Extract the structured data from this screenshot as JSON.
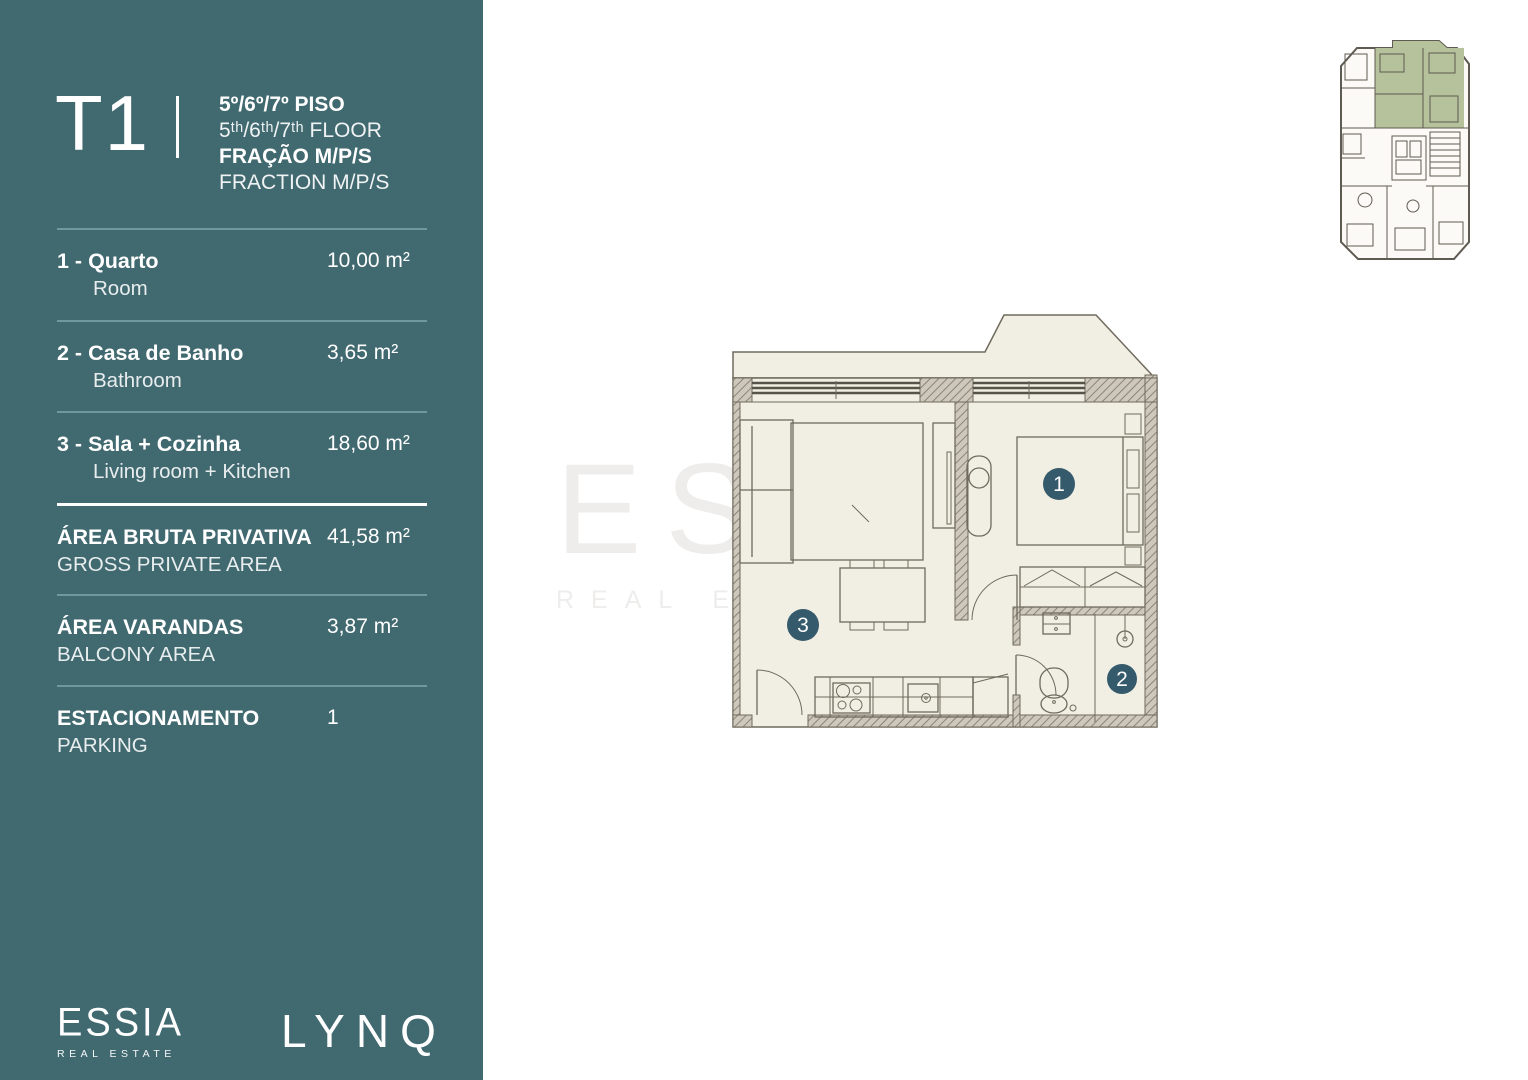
{
  "theme": {
    "sidebar-bg": "#416970",
    "divider": "#6d989c",
    "divider-strong": "#ffffff",
    "plan-floor": "#f1eee3",
    "plan-line": "#6f6a5d",
    "plan-wall-fill": "#cdc8bb",
    "plan-hatch": "#8a8478",
    "plan-glazing": "#57534b",
    "marker-bg": "#355a6b",
    "mini-highlight": "#b5c29c",
    "mini-line": "#5f5b52",
    "watermark": "rgba(150,145,135,0.16)"
  },
  "sidebar": {
    "header": {
      "unit_type": "T1",
      "floor_pt": "5º/6º/7º PISO",
      "floor_en": "5ᵗʰ/6ᵗʰ/7ᵗʰ FLOOR",
      "fraction_pt": "FRAÇÃO M/P/S",
      "fraction_en": "FRACTION M/P/S"
    },
    "rooms": [
      {
        "label_pt": "1 - Quarto",
        "label_en": "Room",
        "area": "10,00 m²"
      },
      {
        "label_pt": "2 - Casa de Banho",
        "label_en": "Bathroom",
        "area": "3,65 m²"
      },
      {
        "label_pt": "3 - Sala + Cozinha",
        "label_en": "Living room + Kitchen",
        "area": "18,60 m²"
      }
    ],
    "summary": [
      {
        "label_pt": "ÁREA BRUTA PRIVATIVA",
        "label_en": "GROSS PRIVATE AREA",
        "value": "41,58 m²"
      },
      {
        "label_pt": "ÁREA VARANDAS",
        "label_en": "BALCONY AREA",
        "value": "3,87 m²"
      },
      {
        "label_pt": "ESTACIONAMENTO",
        "label_en": "PARKING",
        "value": "1"
      }
    ],
    "brand": {
      "name": "ESSIA",
      "tagline": "REAL ESTATE"
    },
    "project": {
      "name": "LYNQ"
    }
  },
  "floorplan": {
    "markers": [
      {
        "number": "1"
      },
      {
        "number": "2"
      },
      {
        "number": "3"
      }
    ]
  },
  "watermark": {
    "line1": "ESSIA",
    "line2": "REAL ESTATE"
  }
}
